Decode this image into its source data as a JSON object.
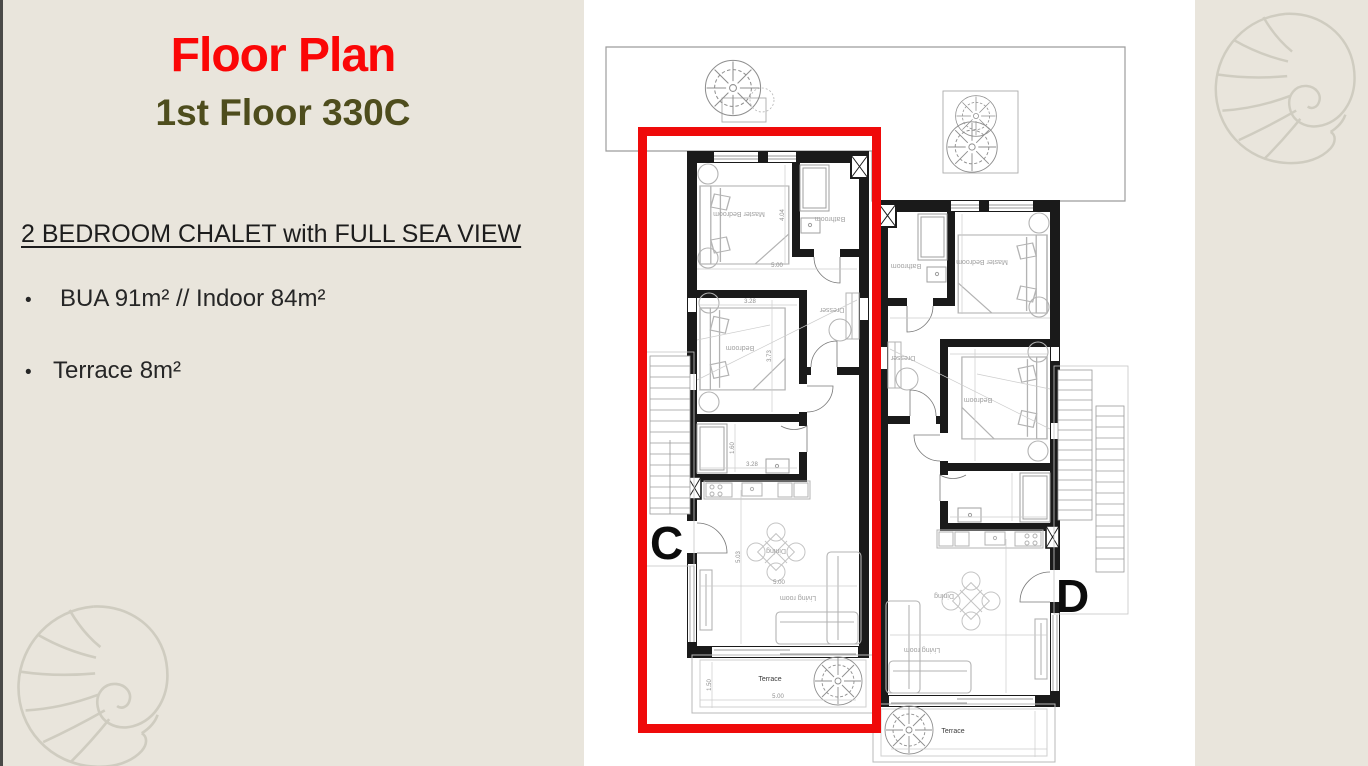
{
  "slide": {
    "title": "Floor Plan",
    "subtitle": "1st Floor 330C",
    "heading": "2 BEDROOM CHALET with FULL SEA VIEW",
    "bullet_glyph": "•",
    "bullets": [
      "BUA 91m² // Indoor 84m²",
      "Terrace 8m²"
    ]
  },
  "plan": {
    "unit_c": {
      "letter": "C",
      "rooms": {
        "master_bedroom": "Master Bedroom",
        "bathroom": "Bathroom",
        "bedroom": "Bedroom",
        "dresser": "Dresser",
        "dining": "Dining",
        "living_room": "Living room",
        "terrace": "Terrace"
      },
      "dimensions": {
        "master_depth": "4.04",
        "master_width": "5.00",
        "bedroom_width": "3.28",
        "bedroom_depth": "3.73",
        "bathroom_depth": "1.60",
        "bathroom_width": "3.28",
        "living_depth": "5.03",
        "living_width": "5.00",
        "terrace_depth": "1.50",
        "terrace_width": "5.00"
      }
    },
    "unit_d": {
      "letter": "D",
      "rooms": {
        "master_bedroom": "Master Bedroom",
        "bathroom": "Bathroom",
        "bedroom": "Bedroom",
        "dresser": "Dresser",
        "dining": "Dining",
        "living_room": "Living room",
        "terrace": "Terrace"
      }
    }
  },
  "colors": {
    "background": "#e9e5dc",
    "title": "#fb0606",
    "subtitle": "#4e4d1d",
    "body_text": "#262626",
    "highlight": "#ef0a0a",
    "walls": "#1a1a1a"
  }
}
